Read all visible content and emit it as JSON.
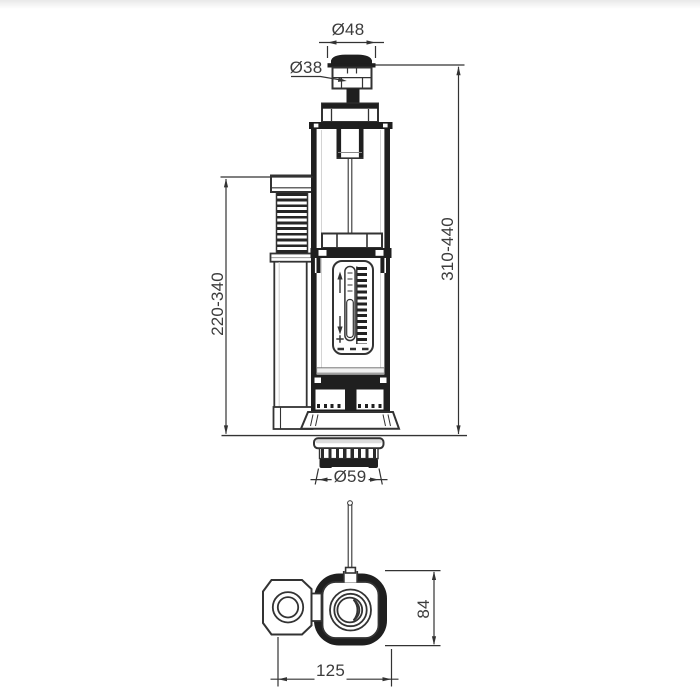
{
  "dims": {
    "d48": "Ø48",
    "d38": "Ø38",
    "d310_440": "310-440",
    "d220_340": "220-340",
    "d59": "Ø59",
    "d84": "84",
    "d125": "125"
  }
}
